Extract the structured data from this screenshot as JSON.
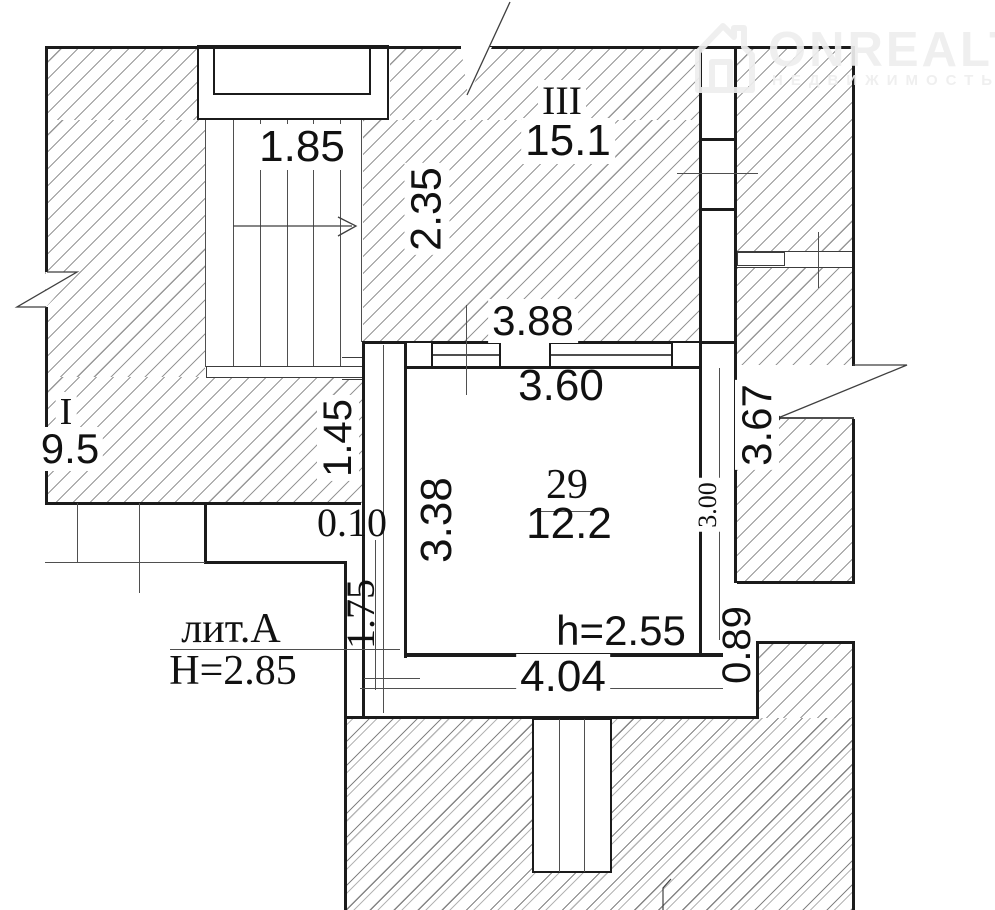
{
  "watermark": {
    "brand": "ONREALT",
    "subtitle": "НЕДВИЖИМОСТЬ",
    "icon": "house-icon"
  },
  "building": {
    "liter": "лит.А",
    "floor_height": "Н=2.85"
  },
  "rooms": [
    {
      "number": "III",
      "area": "15.1"
    },
    {
      "number": "I",
      "area": "9.5"
    },
    {
      "number": "29",
      "area": "12.2",
      "ceiling_height": "h=2.55"
    }
  ],
  "dims": {
    "stair_width": "1.85",
    "stair_flight": "2.35",
    "top_wall": "3.88",
    "room_top": "3.60",
    "left_upper": "1.45",
    "wall_offset": "0.10",
    "room_left": "3.38",
    "room_right": "3.00",
    "right_corridor": "3.67",
    "left_lower": "1.75",
    "room_bottom": "4.04",
    "bottom_right": "0.89"
  },
  "colors": {
    "wall_line": "#1b1b1b",
    "dim_line": "#4f4f4f",
    "hatch_line": "#7d7d7d",
    "watermark": "#eeeeee",
    "background": "#ffffff"
  }
}
